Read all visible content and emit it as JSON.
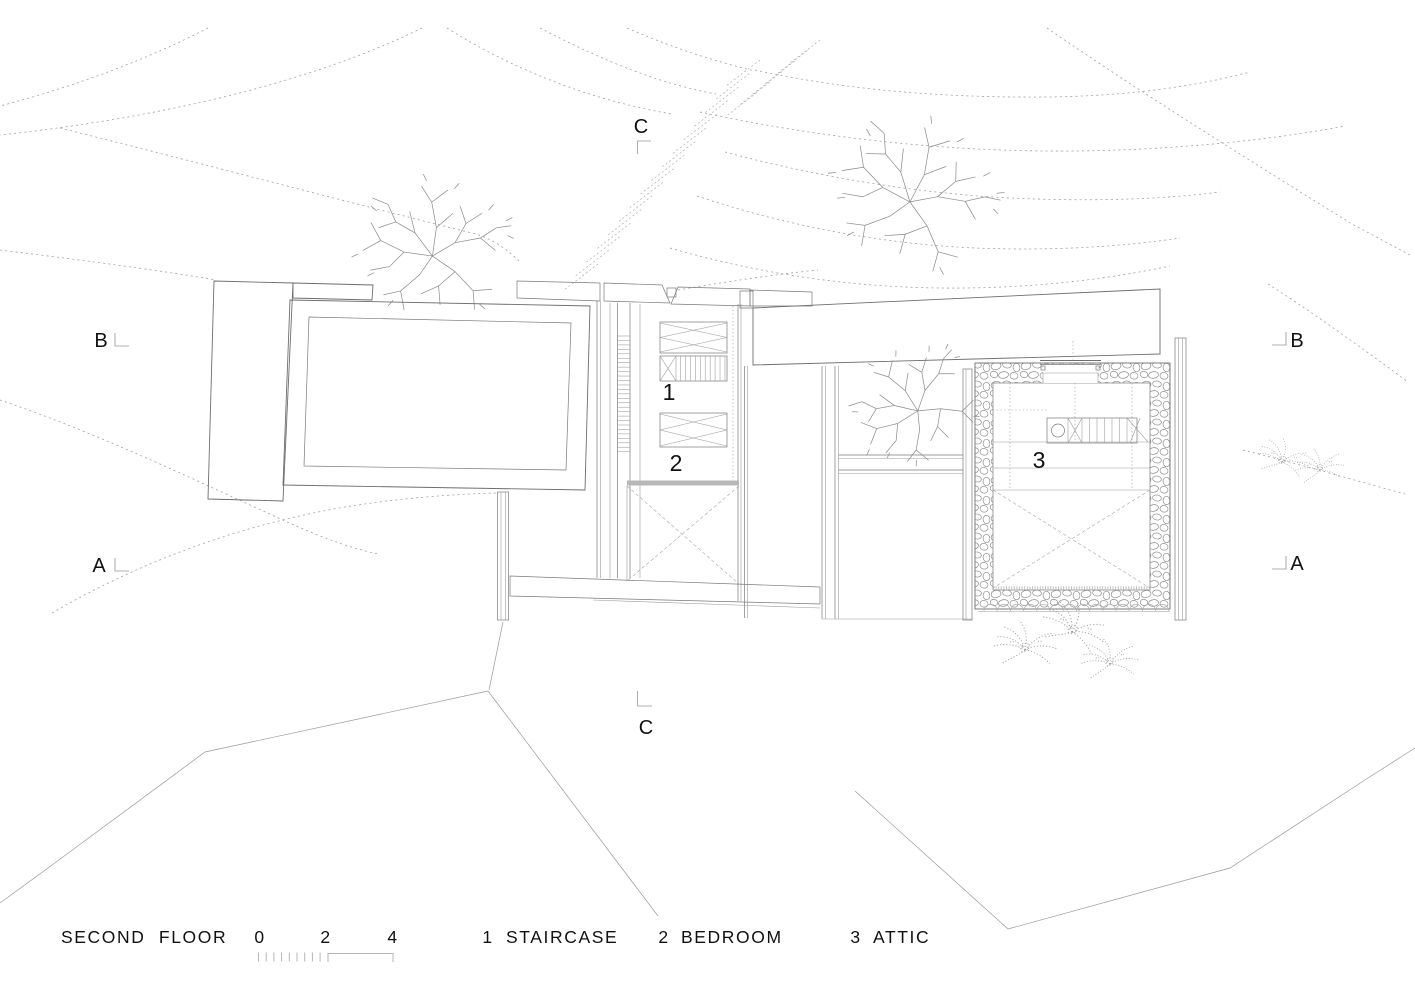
{
  "plan": {
    "floor_title": "SECOND FLOOR",
    "room_labels": {
      "staircase": "1",
      "bedroom": "2",
      "attic": "3"
    },
    "section_markers": {
      "c_top": "C",
      "c_bottom": "C",
      "b_left": "B",
      "b_right": "B",
      "a_left": "A",
      "a_right": "A"
    },
    "scale_bar": {
      "tick_labels": [
        "0",
        "2",
        "4"
      ]
    },
    "legend_items": [
      {
        "num": "1",
        "label": "STAIRCASE"
      },
      {
        "num": "2",
        "label": "BEDROOM"
      },
      {
        "num": "3",
        "label": "ATTIC"
      }
    ],
    "colors": {
      "line": "#6e6e6e",
      "light_line": "#9a9a9a",
      "contour": "#a0a0a0",
      "beam_fill": "#b8b8b8",
      "text": "#111111",
      "background": "#ffffff"
    }
  }
}
